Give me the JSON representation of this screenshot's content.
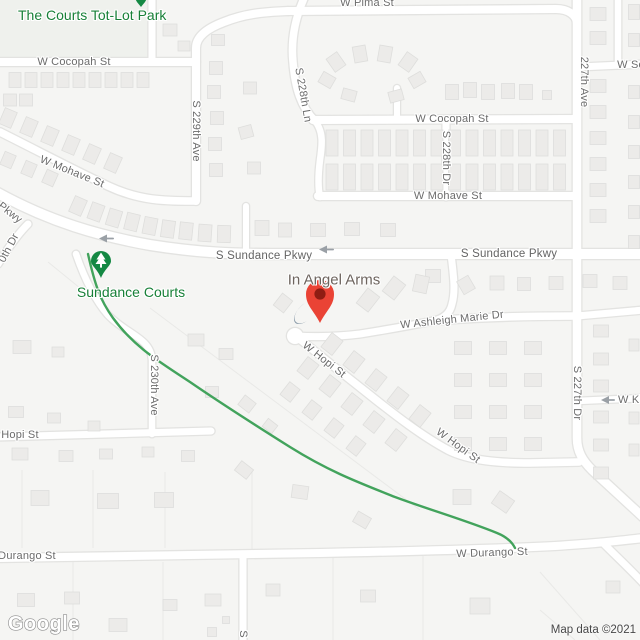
{
  "map": {
    "type": "google-map-embed",
    "attribution": "Map data ©2021",
    "logo_text": "Google",
    "place_result": {
      "name": "In Angel Arms"
    },
    "poi_labels": [
      {
        "id": "courts-tot-lot-park",
        "text": "The Courts Tot-Lot Park",
        "kind": "park"
      },
      {
        "id": "sundance-courts",
        "text": "Sundance Courts",
        "kind": "park"
      }
    ],
    "street_labels": [
      {
        "id": "w-cocopah-left",
        "text": "W Cocopah St"
      },
      {
        "id": "s-229th-ave",
        "text": "S 229th Ave"
      },
      {
        "id": "w-pima",
        "text": "W Pima St"
      },
      {
        "id": "s-228th-ln",
        "text": "S 228th Ln"
      },
      {
        "id": "w-cocopah-right",
        "text": "W Cocopah St"
      },
      {
        "id": "s-228th-dr",
        "text": "S 228th Dr"
      },
      {
        "id": "ave-227th",
        "text": "227th Ave"
      },
      {
        "id": "w-so-frag",
        "text": "W So"
      },
      {
        "id": "w-mohave-left",
        "text": "W Mohave St"
      },
      {
        "id": "w-mohave-right",
        "text": "W Mohave St"
      },
      {
        "id": "pkwy-frag",
        "text": "Pkwy"
      },
      {
        "id": "s-230th-dr-frag",
        "text": "0th Dr"
      },
      {
        "id": "sundance-pkwy-left",
        "text": "S Sundance Pkwy"
      },
      {
        "id": "sundance-pkwy-right",
        "text": "S Sundance Pkwy"
      },
      {
        "id": "w-ashleigh-marie-dr",
        "text": "W Ashleigh Marie Dr"
      },
      {
        "id": "w-hopi-mid",
        "text": "W Hopi St"
      },
      {
        "id": "hopi-left-frag",
        "text": "Hopi St"
      },
      {
        "id": "s-230th-ave",
        "text": "S 230th Ave"
      },
      {
        "id": "s-227th-dr",
        "text": "S 227th Dr"
      },
      {
        "id": "w-ki-frag",
        "text": "W Ki"
      },
      {
        "id": "w-hopi-right",
        "text": "W Hopi St"
      },
      {
        "id": "durango-left-frag",
        "text": "Durango St"
      },
      {
        "id": "w-durango-mid",
        "text": "W Durango St"
      },
      {
        "id": "s-frag-bottom",
        "text": "S"
      }
    ],
    "markers": [
      {
        "id": "red-pin",
        "kind": "place-marker",
        "for": "In Angel Arms"
      },
      {
        "id": "tree-pin",
        "kind": "park-marker",
        "for": "Sundance Courts"
      },
      {
        "id": "tree-pin-tip",
        "kind": "park-marker-partial",
        "for": "The Courts Tot-Lot Park"
      }
    ],
    "colors": {
      "background": "#f5f5f3",
      "road": "#ffffff",
      "road_casing": "#e3e3e1",
      "house": "#ecebe9",
      "house_border": "#dededc",
      "park_label_green": "#188038",
      "pin_green": "#148843",
      "pin_red": "#EA4335",
      "pin_red_dot": "#8F1D13",
      "pin_shadow": "#7d8fa0",
      "trail_green": "#42a35c",
      "street_label_gray": "#6c6c6c",
      "place_label_gray": "#6d645e",
      "attribution_gray": "#474747"
    }
  }
}
